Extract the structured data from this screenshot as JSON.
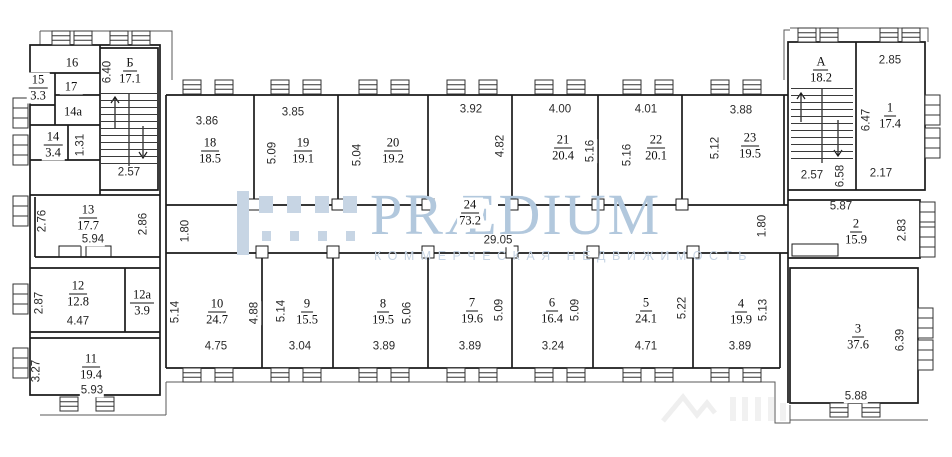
{
  "watermark": {
    "brand": "PRÆDIUM",
    "tagline": "КОММЕРЧЕСКАЯ НЕДВИЖИМОСТЬ",
    "brand_color": "#b2c8dd",
    "tagline_color": "#c6d4e4",
    "logo_color": "#c7d5e4"
  },
  "line_color": "#1b1b1b",
  "rooms": {
    "r1": {
      "num": "1",
      "area": "17.4"
    },
    "r2": {
      "num": "2",
      "area": "15.9"
    },
    "r3": {
      "num": "3",
      "area": "37.6"
    },
    "r4": {
      "num": "4",
      "area": "19.9"
    },
    "r5": {
      "num": "5",
      "area": "24.1"
    },
    "r6": {
      "num": "6",
      "area": "16.4"
    },
    "r7": {
      "num": "7",
      "area": "19.6"
    },
    "r8": {
      "num": "8",
      "area": "19.5"
    },
    "r9": {
      "num": "9",
      "area": "15.5"
    },
    "r10": {
      "num": "10",
      "area": "24.7"
    },
    "r11": {
      "num": "11",
      "area": "19.4"
    },
    "r12": {
      "num": "12",
      "area": "12.8"
    },
    "r12a": {
      "num": "12a",
      "area": "3.9"
    },
    "r13": {
      "num": "13",
      "area": "17.7"
    },
    "r14": {
      "num": "14",
      "area": "3.4"
    },
    "r14a": {
      "num": "14a"
    },
    "r15": {
      "num": "15",
      "area": "3.3"
    },
    "r16": {
      "num": "16"
    },
    "r17": {
      "num": "17"
    },
    "r18": {
      "num": "18",
      "area": "18.5"
    },
    "r19": {
      "num": "19",
      "area": "19.1"
    },
    "r20": {
      "num": "20",
      "area": "19.2"
    },
    "r21": {
      "num": "21",
      "area": "20.4"
    },
    "r22": {
      "num": "22",
      "area": "20.1"
    },
    "r23": {
      "num": "23",
      "area": "19.5"
    },
    "r24": {
      "num": "24",
      "area": "73.2"
    },
    "stairA": {
      "num": "А",
      "area": "18.2"
    },
    "stairB": {
      "num": "Б",
      "area": "17.1"
    }
  },
  "dims": {
    "sb_h": "6.40",
    "sb_w": "2.57",
    "p14": "1.31",
    "r13_l": "2.76",
    "r13_b": "5.94",
    "r13_r": "2.86",
    "r12_l": "2.87",
    "r12_b": "4.47",
    "r11_l": "3.27",
    "r11_b": "5.93",
    "r18_t": "3.86",
    "r19_t": "3.85",
    "r19_l": "5.09",
    "r20_l": "5.04",
    "lobby_t": "3.92",
    "lobby_r": "4.82",
    "r21_t": "4.00",
    "r21_r": "5.16",
    "r22_t": "4.01",
    "r22_l": "5.16",
    "r23_t": "3.88",
    "r23_l": "5.12",
    "sa_w": "2.57",
    "sa_h": "6.58",
    "r1_t": "2.85",
    "r1_l": "6.47",
    "r1_b": "2.17",
    "r2_t": "5.87",
    "r2_r": "2.83",
    "r3_r": "6.39",
    "r3_b": "5.88",
    "cor_wl": "1.80",
    "cor_len": "29.05",
    "cor_wr": "1.80",
    "r10_l": "5.14",
    "r10_r": "4.88",
    "r10_b": "4.75",
    "r9_l": "5.14",
    "r9_b": "3.04",
    "r8_r": "5.06",
    "r8_b": "3.89",
    "r7_r": "5.09",
    "r7_b": "3.89",
    "r6_r": "5.09",
    "r6_b": "3.24",
    "r5_r": "5.22",
    "r5_b": "4.71",
    "r4_r": "5.13",
    "r4_b": "3.89"
  }
}
